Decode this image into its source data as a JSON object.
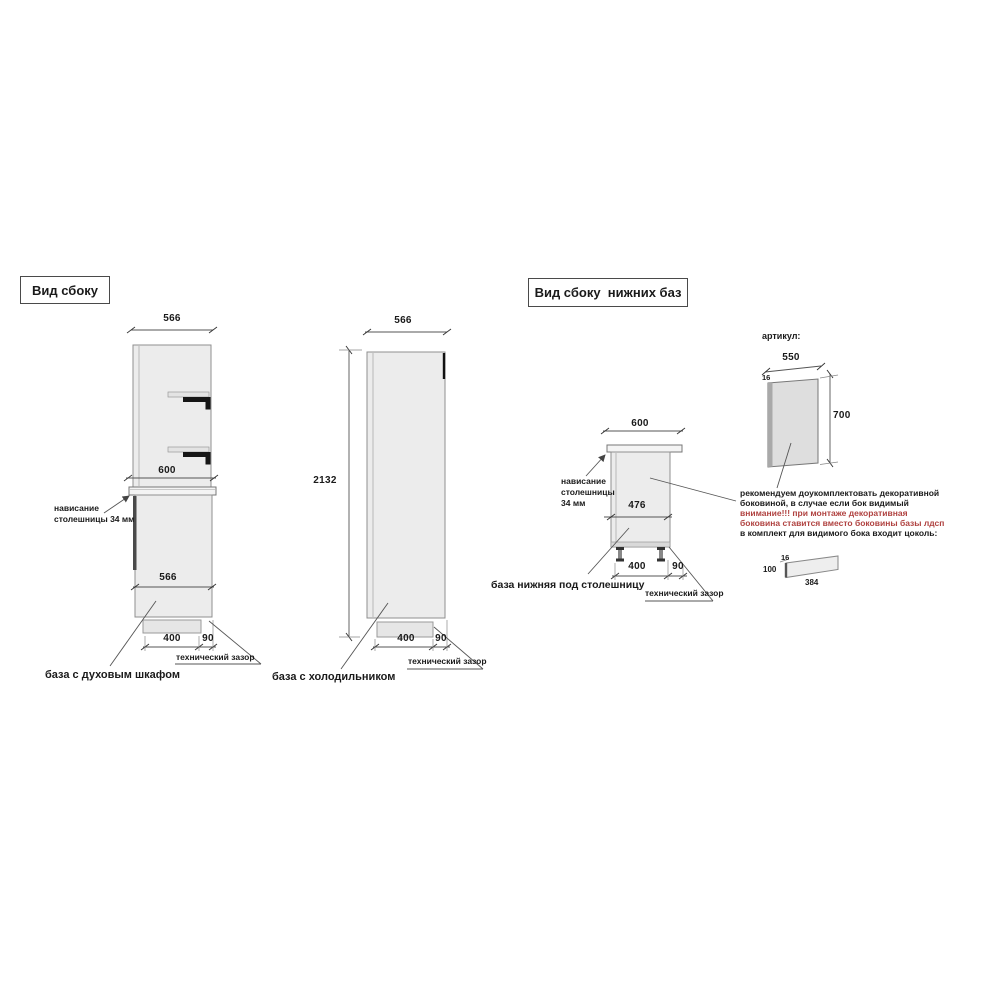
{
  "left_panel": {
    "title": "Вид сбоку",
    "oven_base": {
      "top_width": "566",
      "counter_width": "600",
      "body_width": "566",
      "overhang_line1": "нависание",
      "overhang_line2": "столешницы 34 мм",
      "plinth_depth": "400",
      "gap": "90",
      "gap_label": "технический зазор",
      "caption": "база с духовым шкафом"
    },
    "fridge_base": {
      "top_width": "566",
      "height": "2132",
      "plinth_depth": "400",
      "gap": "90",
      "gap_label": "технический зазор",
      "caption": "база с холодильником"
    }
  },
  "right_panel": {
    "title": "Вид сбоку  нижних баз",
    "lower_base": {
      "top_width": "600",
      "body_depth": "476",
      "overhang_line1": "нависание",
      "overhang_line2": "столешницы",
      "overhang_line3": "34 мм",
      "plinth_depth": "400",
      "gap": "90",
      "gap_label": "технический зазор",
      "caption": "база нижняя под столешницу"
    },
    "side_panel": {
      "article_label": "артикул:",
      "width": "550",
      "thickness": "16",
      "height": "700"
    },
    "note": {
      "line1": "рекомендуем доукомплектовать декоративной",
      "line2": "боковиной, в случае если бок видимый",
      "line3": "внимание!!! при монтаже декоративная",
      "line4": "боковина ставится вместо боковины базы лдсп",
      "line5": "в комплект для видимого бока входит цоколь:",
      "warning_color": "#b04240"
    },
    "plinth": {
      "thickness": "16",
      "height": "100",
      "length": "384"
    }
  }
}
